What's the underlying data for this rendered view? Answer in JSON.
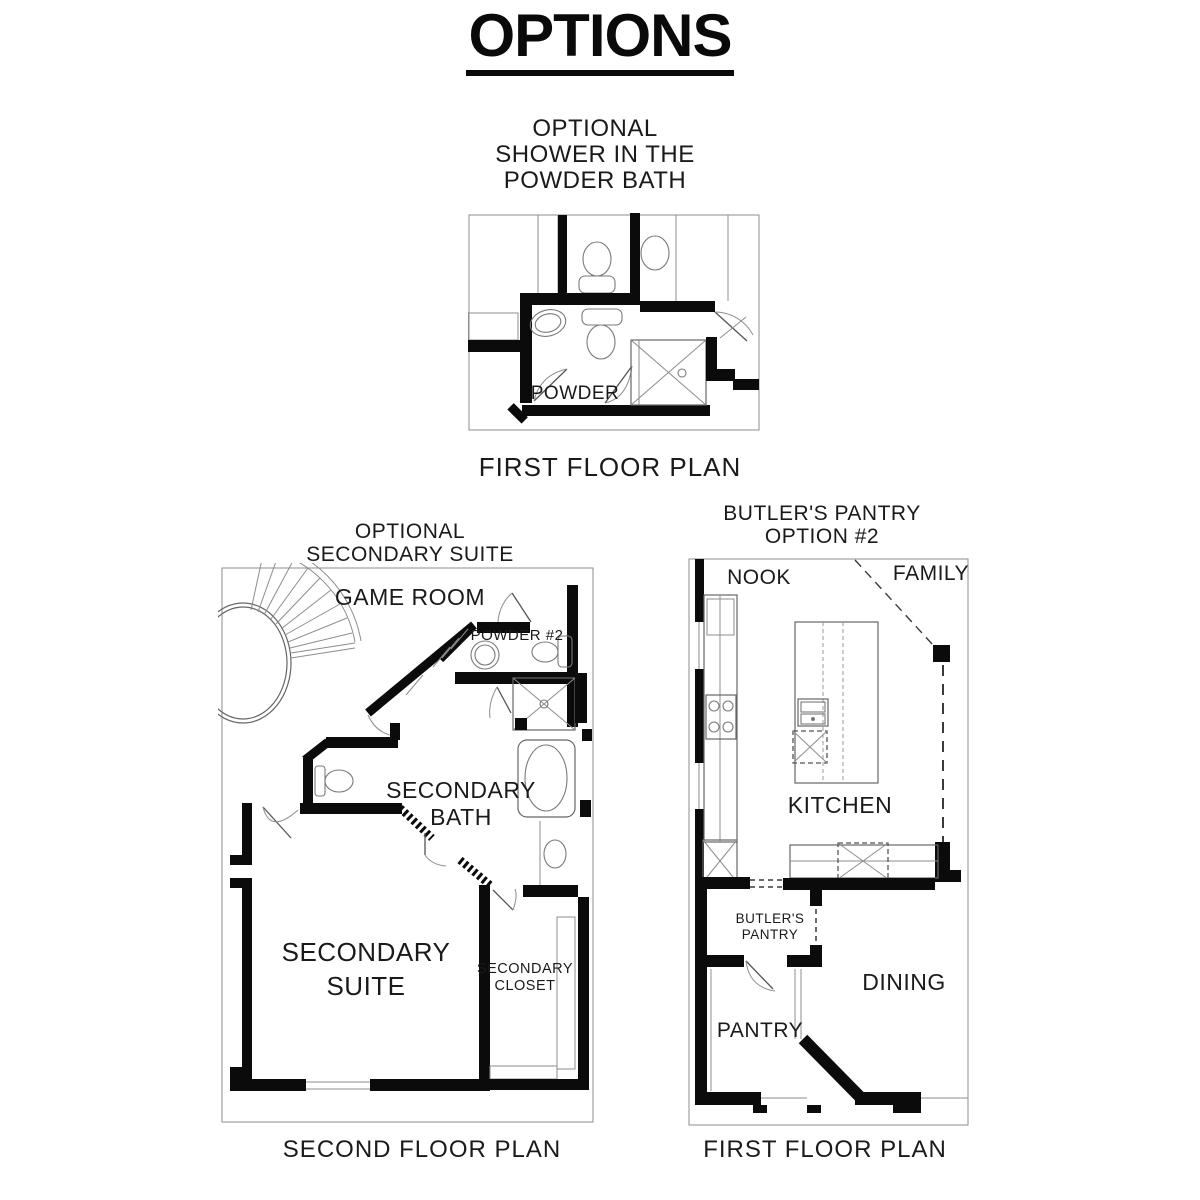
{
  "page": {
    "title": "OPTIONS",
    "ink": "#0b0b0b",
    "thin_line": "#8d8d8d",
    "background": "#ffffff"
  },
  "plan_powder_bath": {
    "heading_line1": "OPTIONAL",
    "heading_line2": "SHOWER IN THE",
    "heading_line3": "POWDER BATH",
    "caption": "FIRST FLOOR PLAN",
    "rooms": {
      "powder": "POWDER"
    }
  },
  "plan_secondary_suite": {
    "heading_line1": "OPTIONAL",
    "heading_line2": "SECONDARY SUITE",
    "caption": "SECOND FLOOR PLAN",
    "rooms": {
      "game_room": "GAME ROOM",
      "powder2": "POWDER #2",
      "bath_line1": "SECONDARY",
      "bath_line2": "BATH",
      "suite_line1": "SECONDARY",
      "suite_line2": "SUITE",
      "closet_line1": "SECONDARY",
      "closet_line2": "CLOSET"
    }
  },
  "plan_butlers_pantry": {
    "heading_line1": "BUTLER'S PANTRY",
    "heading_line2": "OPTION #2",
    "caption": "FIRST FLOOR PLAN",
    "rooms": {
      "nook": "NOOK",
      "family": "FAMILY",
      "kitchen": "KITCHEN",
      "butlers_line1": "BUTLER'S",
      "butlers_line2": "PANTRY",
      "pantry": "PANTRY",
      "dining": "DINING"
    }
  }
}
